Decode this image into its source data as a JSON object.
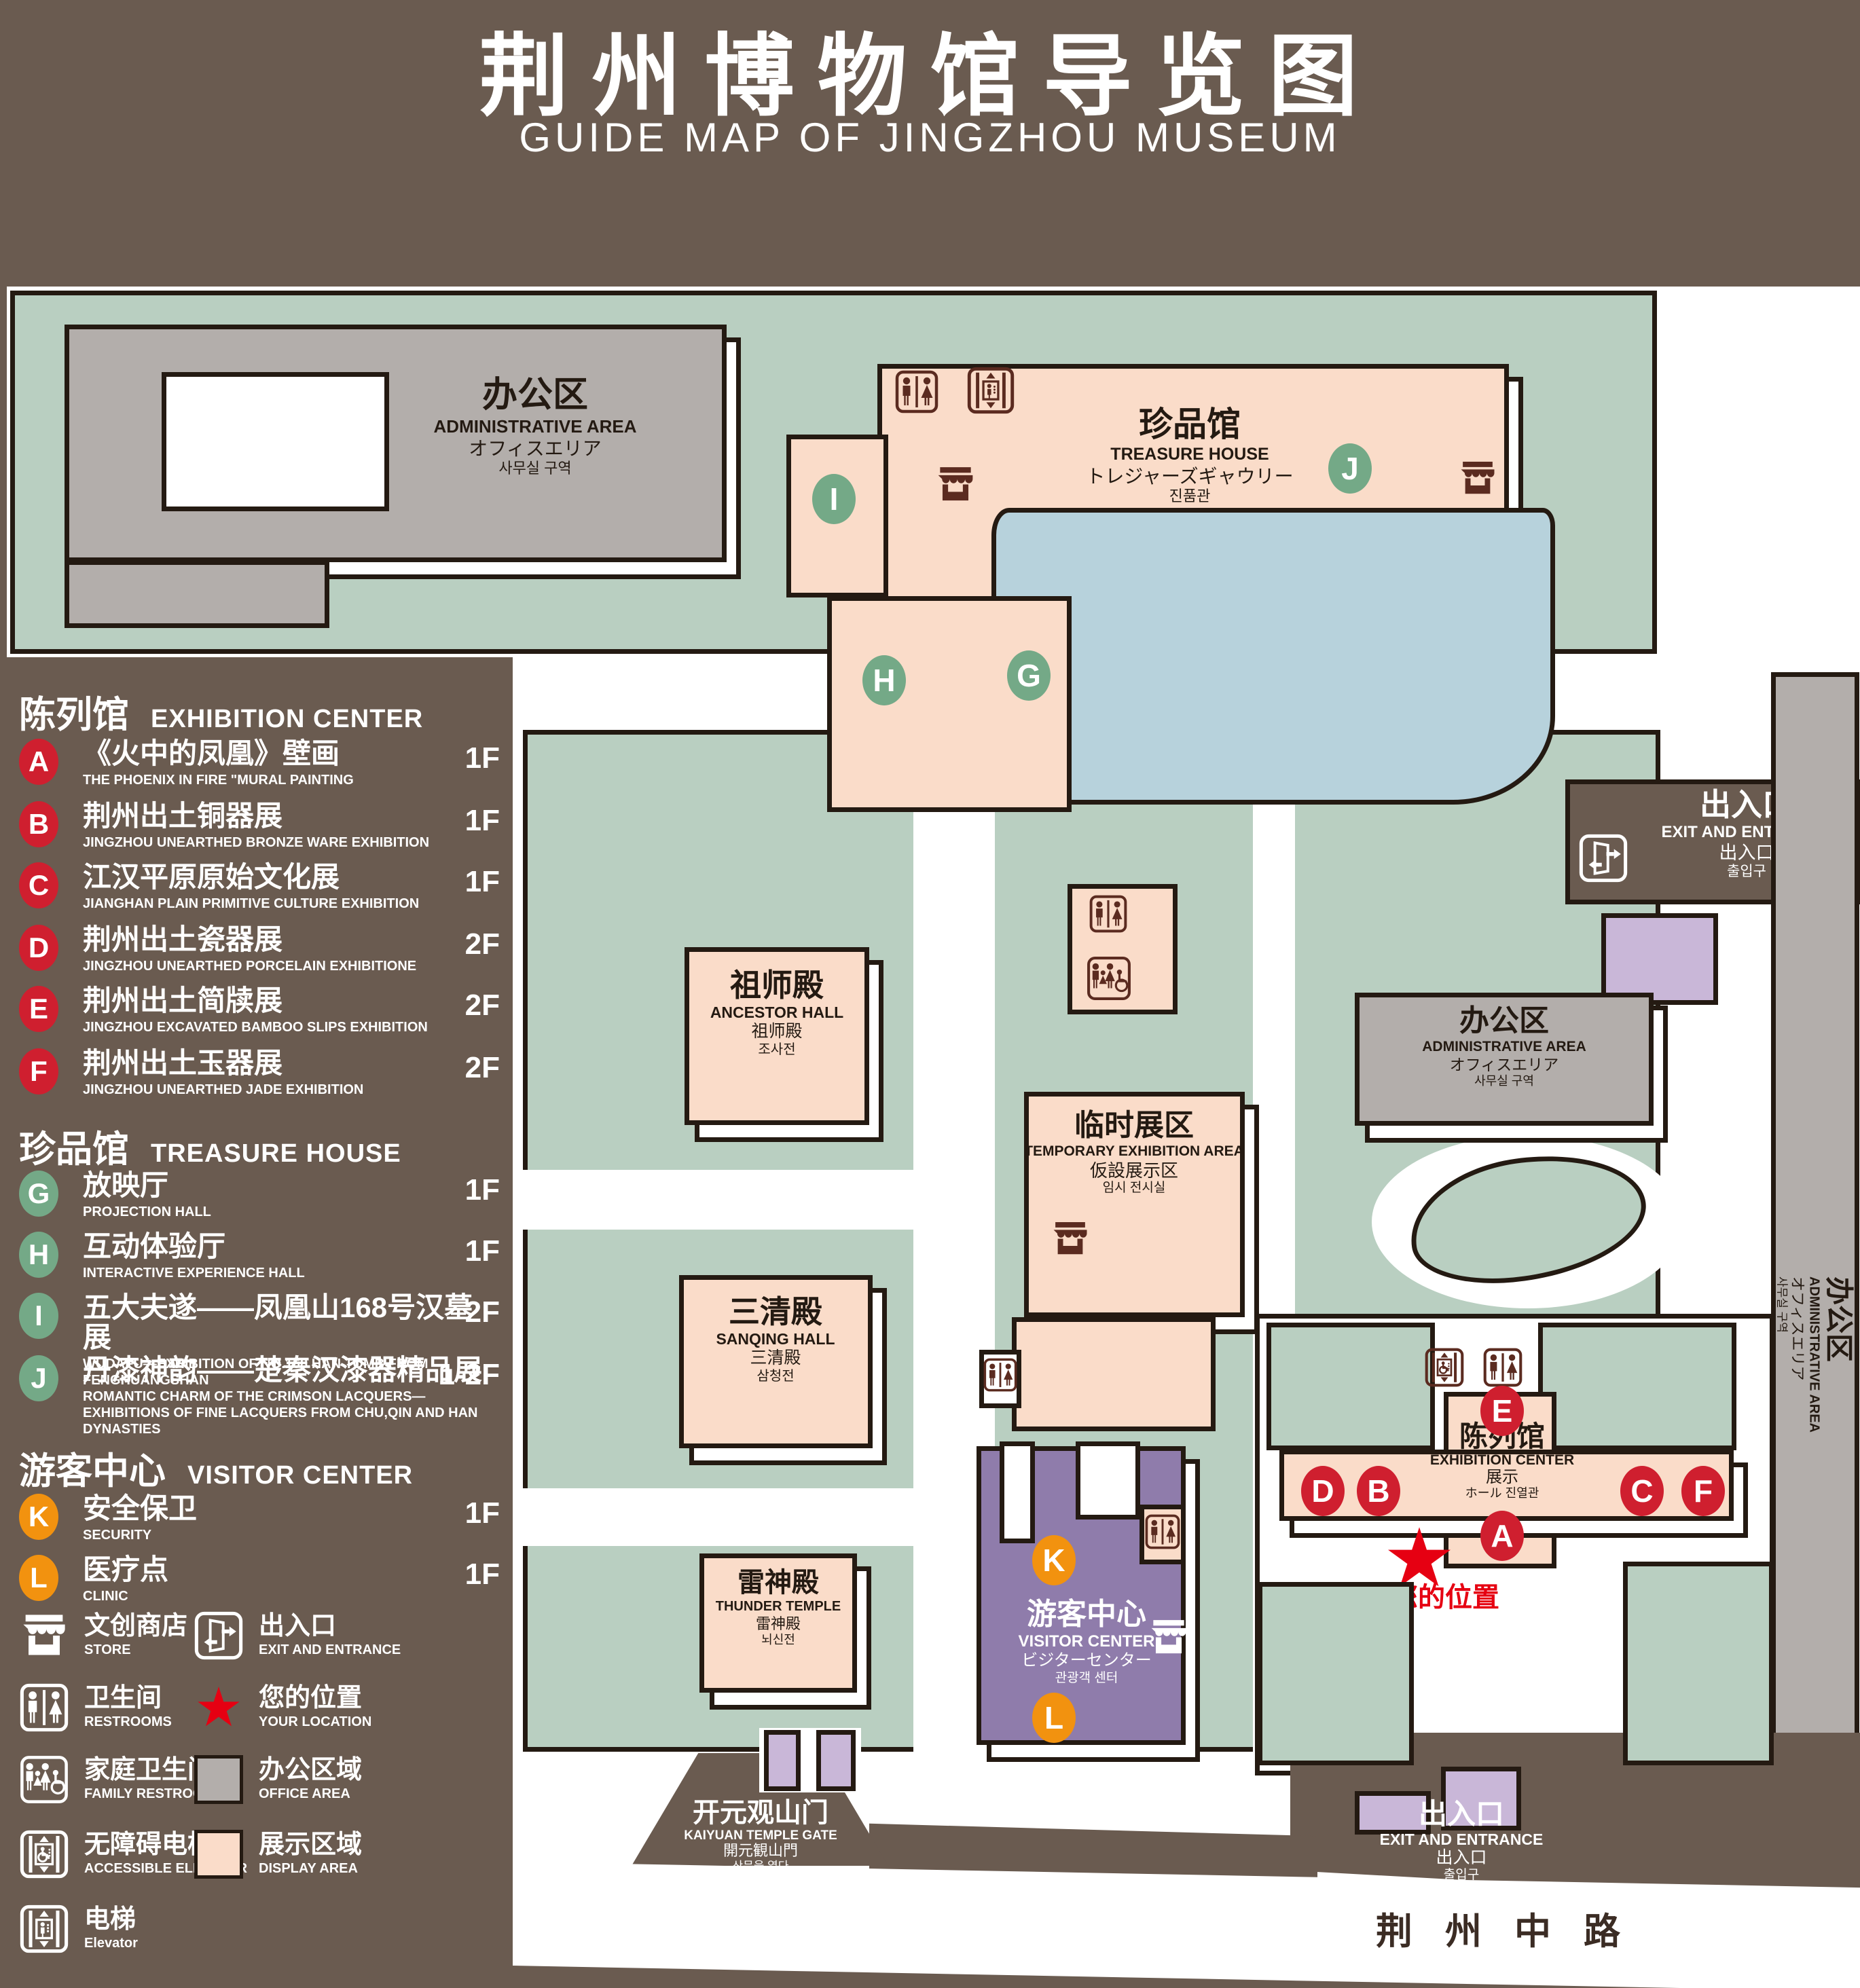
{
  "header": {
    "title": "荆州博物馆导览图",
    "subtitle": "GUIDE MAP OF JINGZHOU MUSEUM"
  },
  "legend": {
    "sections": [
      {
        "zh": "陈列馆",
        "en": "EXHIBITION CENTER",
        "items": [
          {
            "letter": "A",
            "zh": "《火中的凤凰》壁画",
            "en": "THE PHOENIX IN FIRE \"MURAL PAINTING",
            "floor": "1F"
          },
          {
            "letter": "B",
            "zh": "荆州出土铜器展",
            "en": "JINGZHOU UNEARTHED BRONZE WARE EXHIBITION",
            "floor": "1F"
          },
          {
            "letter": "C",
            "zh": "江汉平原原始文化展",
            "en": "JIANGHAN PLAIN PRIMITIVE CULTURE EXHIBITION",
            "floor": "1F"
          },
          {
            "letter": "D",
            "zh": "荆州出土瓷器展",
            "en": "JINGZHOU UNEARTHED PORCELAIN EXHIBITIONE",
            "floor": "2F"
          },
          {
            "letter": "E",
            "zh": "荆州出土简牍展",
            "en": "JINGZHOU EXCAVATED BAMBOO SLIPS EXHIBITION",
            "floor": "2F"
          },
          {
            "letter": "F",
            "zh": "荆州出土玉器展",
            "en": "JINGZHOU UNEARTHED JADE EXHIBITION",
            "floor": "2F"
          }
        ]
      },
      {
        "zh": "珍品馆",
        "en": "TREASURE HOUSE",
        "items": [
          {
            "letter": "G",
            "zh": "放映厅",
            "en": "PROJECTION HALL",
            "floor": "1F"
          },
          {
            "letter": "H",
            "zh": "互动体验厅",
            "en": "INTERACTIVE EXPERIENCE HALL",
            "floor": "1F"
          },
          {
            "letter": "I",
            "zh": "五大夫遂——凤凰山168号汉墓展",
            "en": "WUDAFU—EXHIBITION OF NO.168 HAN TOMB FROM FENGHUANGSHAN",
            "floor": "2F"
          },
          {
            "letter": "J",
            "zh": "丹漆神韵——楚秦汉漆器精品展",
            "en": "ROMANTIC CHARM OF THE CRIMSON LACQUERS—EXHIBITIONS OF FINE LACQUERS FROM CHU,QIN AND HAN DYNASTIES",
            "floor": "1-2F"
          }
        ]
      },
      {
        "zh": "游客中心",
        "en": "VISITOR CENTER",
        "items": [
          {
            "letter": "K",
            "zh": "安全保卫",
            "en": "SECURITY",
            "floor": "1F"
          },
          {
            "letter": "L",
            "zh": "医疗点",
            "en": "CLINIC",
            "floor": "1F"
          }
        ]
      }
    ],
    "icons": [
      {
        "zh": "文创商店",
        "en": "STORE"
      },
      {
        "zh": "出入口",
        "en": "EXIT AND ENTRANCE"
      },
      {
        "zh": "卫生间",
        "en": "RESTROOMS"
      },
      {
        "zh": "您的位置",
        "en": "YOUR LOCATION"
      },
      {
        "zh": "家庭卫生间",
        "en": "FAMILY RESTROOMS"
      },
      {
        "zh": "办公区域",
        "en": "OFFICE AREA"
      },
      {
        "zh": "无障碍电梯",
        "en": "ACCESSIBLE ELEVATOR"
      },
      {
        "zh": "展示区域",
        "en": "DISPLAY AREA"
      },
      {
        "zh": "电梯",
        "en": "Elevator"
      }
    ]
  },
  "map": {
    "buildings": {
      "admin_top_left": {
        "zh": "办公区",
        "en": "ADMINISTRATIVE AREA",
        "ja": "オフィスエリア",
        "ko": "사무실 구역"
      },
      "treasure_house": {
        "zh": "珍品馆",
        "en": "TREASURE HOUSE",
        "ja": "トレジャーズギャウリー",
        "ko": "진품관"
      },
      "admin_center_right": {
        "zh": "办公区",
        "en": "ADMINISTRATIVE AREA",
        "ja": "オフィスエリア",
        "ko": "사무실 구역"
      },
      "admin_right": {
        "zh": "办公区",
        "en": "ADMINISTRATIVE AREA",
        "ja": "オフィスエリア",
        "ko": "사무실 구역"
      },
      "ancestor_hall": {
        "zh": "祖师殿",
        "en": "ANCESTOR HALL",
        "ja": "祖师殿",
        "ko": "조사전"
      },
      "temporary_exhibition": {
        "zh": "临时展区",
        "en": "TEMPORARY EXHIBITION AREA",
        "ja": "仮設展示区",
        "ko": "임시 전시실"
      },
      "sanqing_hall": {
        "zh": "三清殿",
        "en": "SANQING HALL",
        "ja": "三清殿",
        "ko": "삼청전"
      },
      "thunder_temple": {
        "zh": "雷神殿",
        "en": "THUNDER TEMPLE",
        "ja": "雷神殿",
        "ko": "뇌신전"
      },
      "visitor_center": {
        "zh": "游客中心",
        "en": "VISITOR CENTER",
        "ja": "ビジターセンター",
        "ko": "관광객 센터"
      },
      "exhibition_center": {
        "zh": "陈列馆",
        "en": "EXHIBITION CENTER",
        "ja": "展示",
        "ko": "ホール 진열관"
      },
      "exit_right": {
        "zh": "出入口",
        "en": "EXIT AND ENTRANCE",
        "ja": "出入口",
        "ko": "출입구"
      },
      "exit_bottom": {
        "zh": "出入口",
        "en": "EXIT AND ENTRANCE",
        "ja": "出入口",
        "ko": "출입구"
      },
      "gate": {
        "zh": "开元观山门",
        "en": "KAIYUAN TEMPLE GATE",
        "ja": "開元観山門",
        "ko": "산문을 열다"
      },
      "road": {
        "zh": "荆州中路"
      },
      "your_location": {
        "zh": "您的位置"
      }
    },
    "letters": {
      "A": "A",
      "B": "B",
      "C": "C",
      "D": "D",
      "E": "E",
      "F": "F",
      "G": "G",
      "H": "H",
      "I": "I",
      "J": "J",
      "K": "K",
      "L": "L"
    }
  }
}
